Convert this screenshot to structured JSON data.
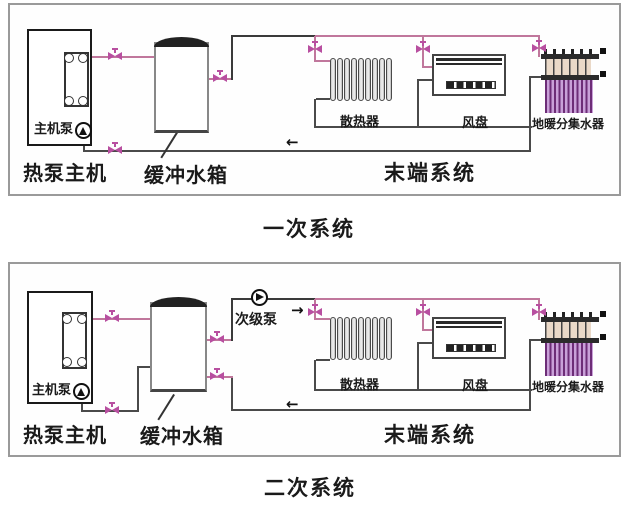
{
  "captions": {
    "primary": "一次系统",
    "secondary": "二次系统"
  },
  "labels": {
    "heat_pump_unit": "热泵主机",
    "main_unit_pump": "主机泵",
    "buffer_tank": "缓冲水箱",
    "terminal_system": "末端系统",
    "radiator": "散热器",
    "fan_coil": "风盘",
    "floor_manifold": "地暖分集水器",
    "secondary_pump": "次级泵"
  },
  "icons": {
    "arrow_left": "←",
    "arrow_right": "→",
    "valve": "valve-icon",
    "pump": "pump-icon"
  },
  "colors": {
    "supply_pipe": "#c0779c",
    "return_pipe": "#4a4a4a",
    "valve": "#b84fa0",
    "manifold_loop": "#7d3c98"
  },
  "counts": {
    "radiator_fins": 9
  }
}
